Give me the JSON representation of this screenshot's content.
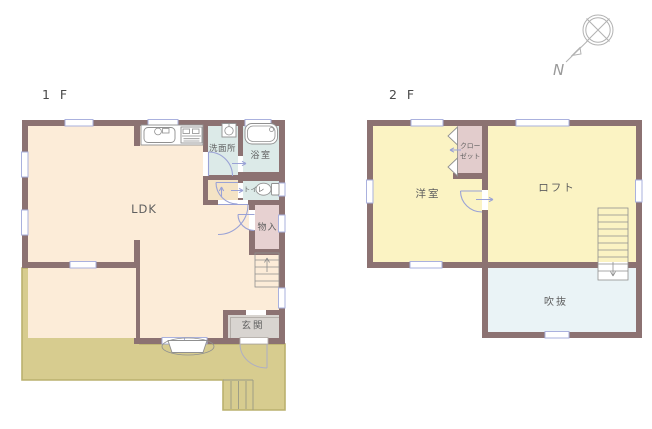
{
  "palette": {
    "wall": "#8c7272",
    "ldk_floor": "#fcecd8",
    "wet_floor": "#dceae8",
    "hall_floor": "#f4e3c5",
    "storage_floor": "#e7d1d1",
    "entrance_floor": "#d8d4d0",
    "deck_fill": "#d7cc8f",
    "deck_border": "#bab06e",
    "room2f_floor": "#fbf3c3",
    "closet_floor": "#e2cccc",
    "void_floor": "#eaf3f6",
    "window_stroke": "#aab1de",
    "door_arc": "#9aa2d6",
    "fixture_stroke": "#909090",
    "label_text": "#5f5f5f",
    "compass_stroke": "#b2b2b2",
    "background": "#ffffff"
  },
  "floor1": {
    "label": "1 F",
    "rooms": {
      "ldk": "LDK",
      "washroom": "洗面所",
      "bath": "浴室",
      "toilet": "トイレ",
      "storage": "物入",
      "entrance": "玄関"
    }
  },
  "floor2": {
    "label": "2 F",
    "rooms": {
      "bedroom": "洋室",
      "loft": "ロフト",
      "closet1": "クロー",
      "closet2": "ゼット",
      "void": "吹抜"
    }
  },
  "compass": {
    "north_label": "N"
  }
}
